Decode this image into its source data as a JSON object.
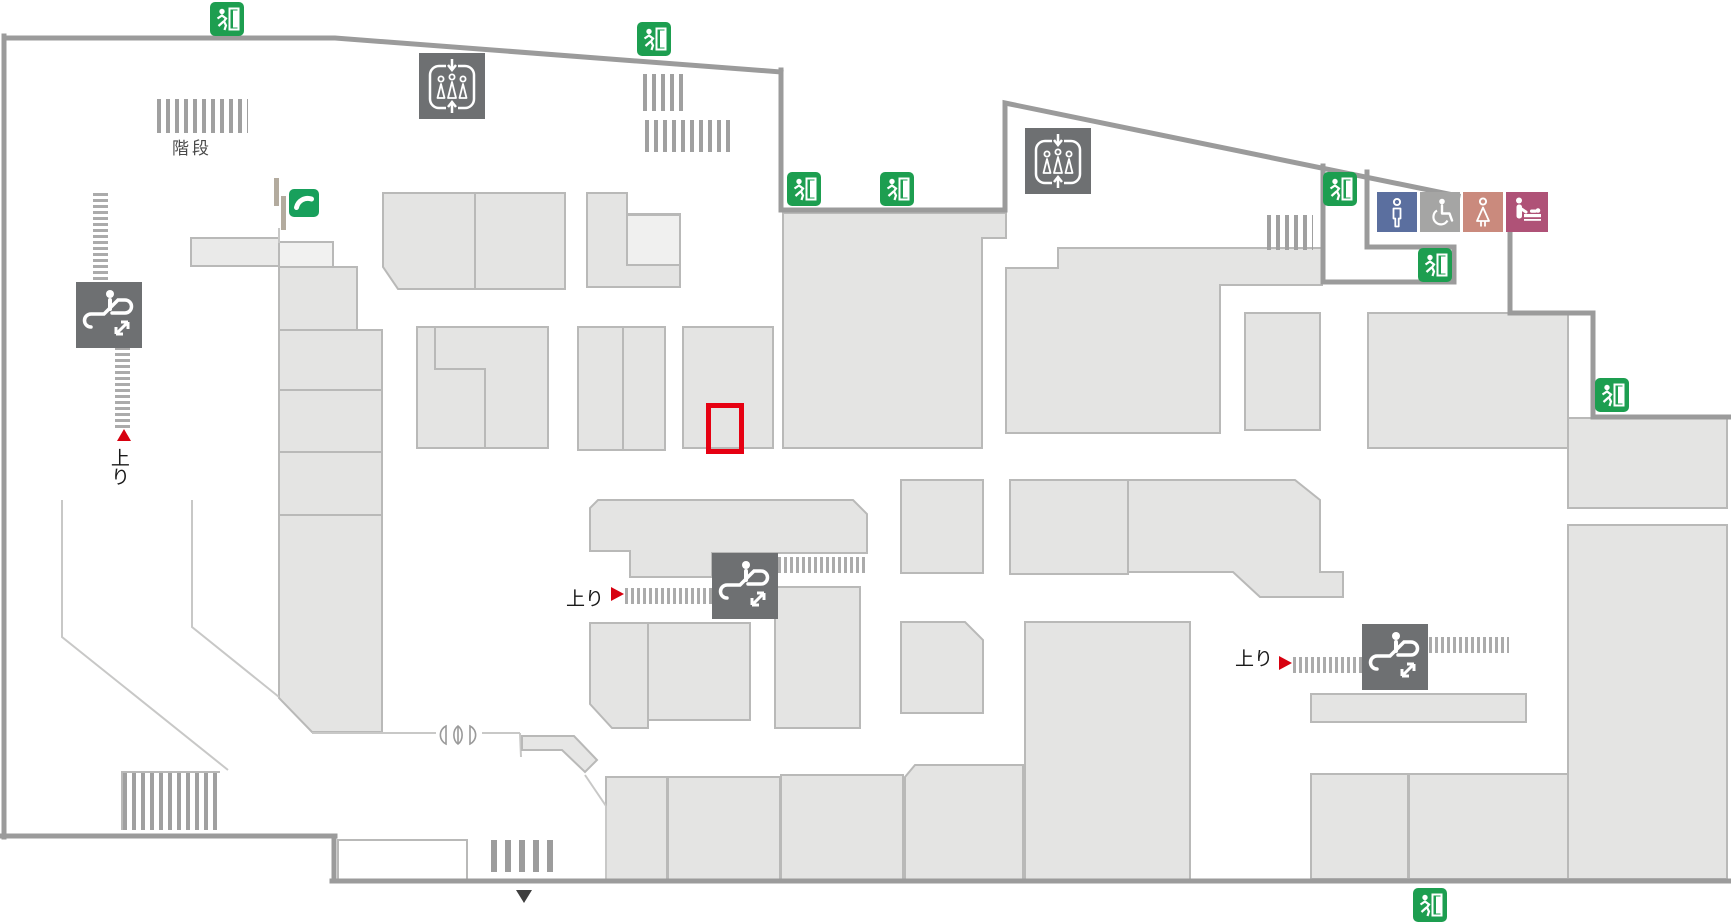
{
  "map": {
    "labels": {
      "stairs": "階段",
      "up_left": "上り",
      "up_center": "上り",
      "up_right": "上り"
    },
    "markers": {
      "highlight": "current-shop-location",
      "entrance_arrow": "entrance"
    },
    "icons": {
      "exit": "emergency-exit",
      "elevator": "elevator",
      "escalator": "escalator",
      "phone": "public-phone",
      "mens": "mens-restroom",
      "accessible": "accessible-restroom",
      "womens": "womens-restroom",
      "baby": "baby-changing-room"
    },
    "counts": {
      "exit_signs": 8,
      "elevators": 2,
      "escalators": 3
    },
    "colors": {
      "exit_green": "#1d9e50",
      "phone_green": "#18a05c",
      "facility_gray": "#6e7072",
      "mens_blue": "#5b6f9f",
      "accessible_gray": "#a5a5a4",
      "womens_pink": "#ca8a7d",
      "baby_magenta": "#af5277",
      "highlight_red": "#e60012",
      "arrow_red": "#d7000f",
      "block_fill": "#e4e4e3",
      "wall_gray": "#9b9b9b"
    }
  }
}
